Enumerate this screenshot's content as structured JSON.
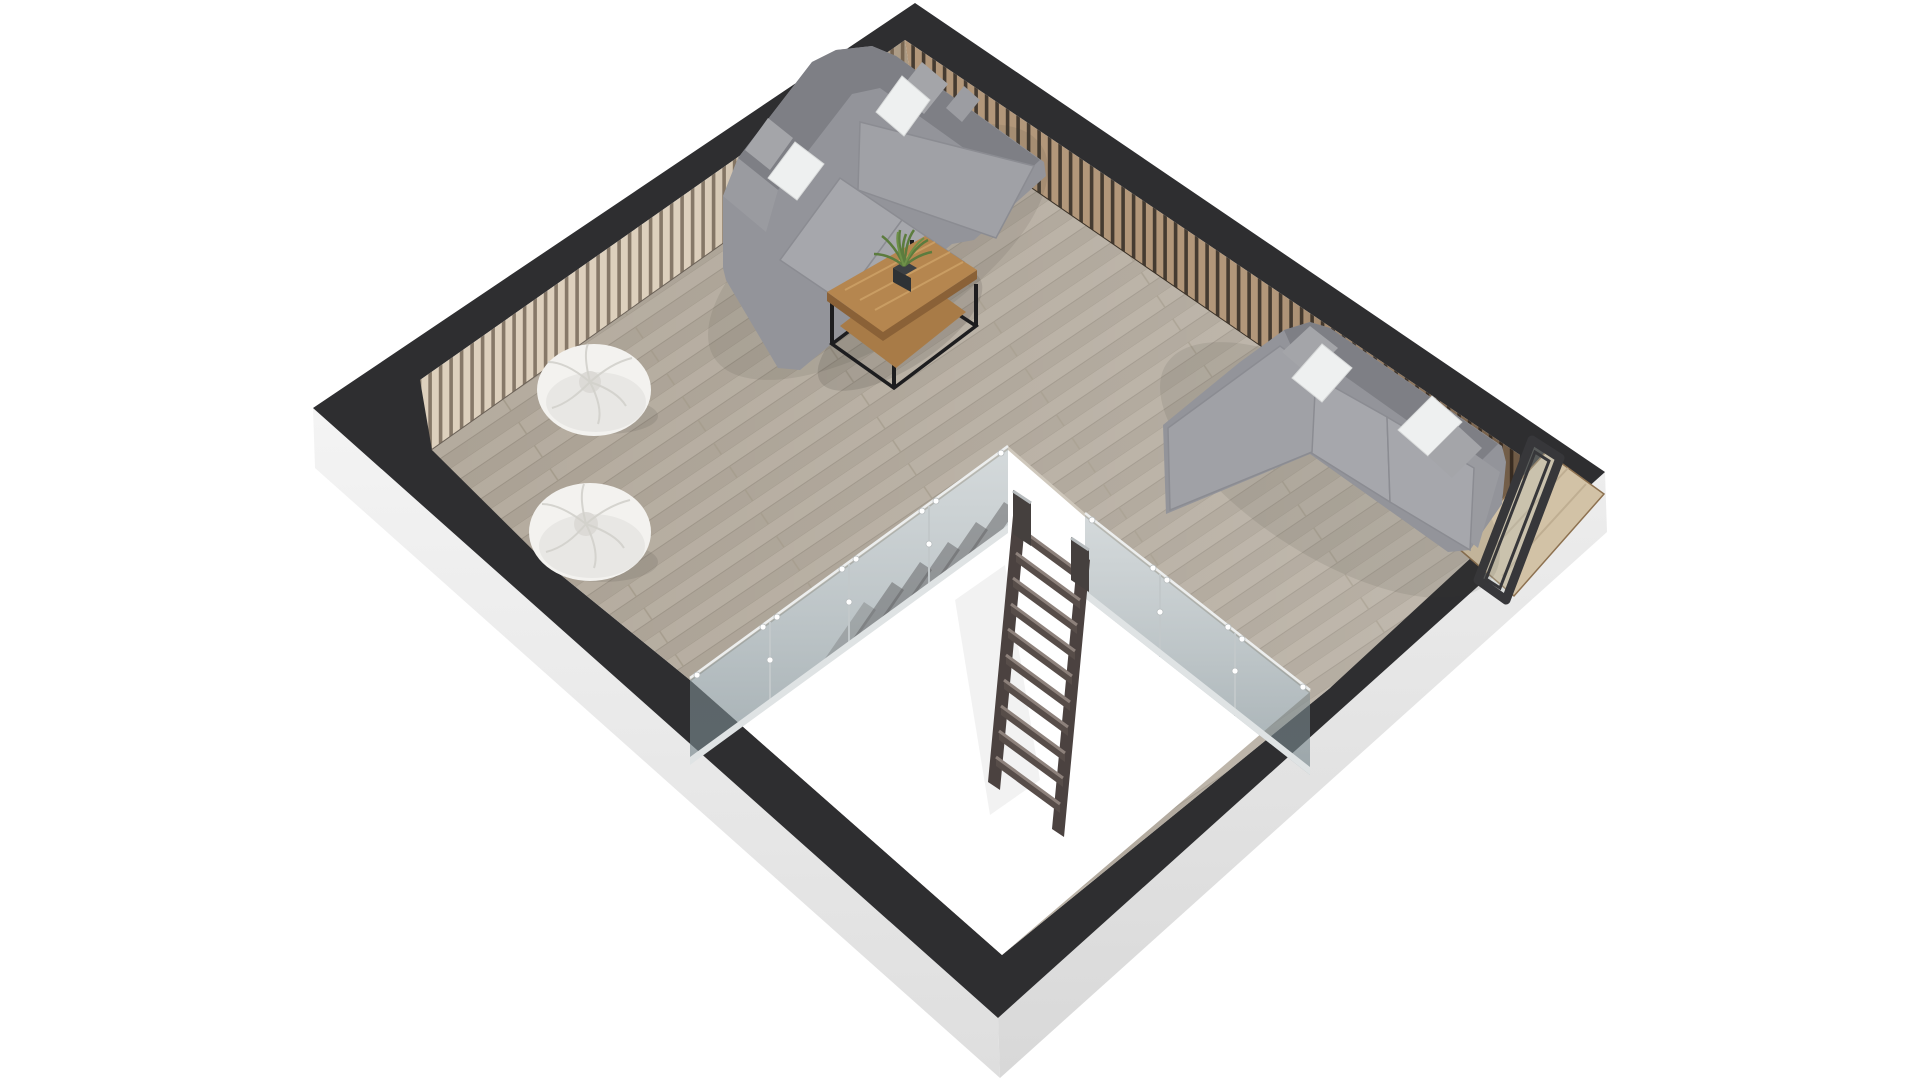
{
  "scene": {
    "type": "3d-floor-plan-render",
    "view": "isometric top-down dollhouse view",
    "room": "attic loft lounge with stairwell opening",
    "objects": [
      "dark wall caps (rotated square plan)",
      "white exterior wall faces",
      "vertical wood-slat interior paneling (light on upper-left wall, brown on upper-right wall)",
      "gray plank wood floor",
      "L-shaped sectional sofa at top corner with throw pillows",
      "L-shaped sectional sofa at right wall with throw pillows",
      "wood coffee table with black metal frame and lower shelf",
      "potted green plant on coffee table",
      "two white bean bags",
      "stairwell floor opening",
      "glass balustrade left of opening",
      "glass balustrade right of opening",
      "dark wood ship ladder descending through opening",
      "dark-framed window recess at right corner with wood threshold"
    ],
    "counts": {
      "sectional_sofas": 2,
      "bean_bags": 2,
      "throw_pillows": 9,
      "ladder_treads": 10,
      "glass_panels_left": 4,
      "glass_panels_right": 3
    }
  },
  "colors": {
    "background": "#ffffff",
    "wall_top": "#2e2e30",
    "wall_outer_left": "#f1f1f1",
    "wall_outer_right": "#e7e7e7",
    "floor_base": "#b0a79a",
    "floor_stripe_light": "#b4ab9e",
    "floor_stripe_dark": "#aaa194",
    "plank_gap": "#9b9285",
    "slat_face": "#ddd0bd",
    "slat_gap": "#867868",
    "slat_face_right": "#b2977a",
    "slat_gap_right": "#453b31",
    "void_white": "#ffffff",
    "rim": "#cfc8bc",
    "sofa_base": "#93949a",
    "sofa_back": "#7e7f85",
    "sofa_cushion": "#a6a7ac",
    "sofa_armrest": "#9a9ba0",
    "pillow_white": "#eef0f0",
    "pillow_gray": "#a4a5a9",
    "table_wood": "#b5864f",
    "table_wood_dark": "#8a6137",
    "table_shelf": "#a87b47",
    "table_frame": "#1d1d1f",
    "plant_green": "#5c7c3e",
    "plant_pot": "#3c4043",
    "beanbag": "#f3f2ef",
    "beanbag_fold": "#d2d0cb",
    "glass_tint": "#8fa0a4",
    "glass_rail": "#dfe3e4",
    "ladder_wood": "#4b4240",
    "ladder_tread_face": "#574d49",
    "ladder_tread_top": "#8d817b",
    "window_frame": "#37373a",
    "threshold": "#d2c2a6",
    "threshold_edge": "#8d7150"
  }
}
